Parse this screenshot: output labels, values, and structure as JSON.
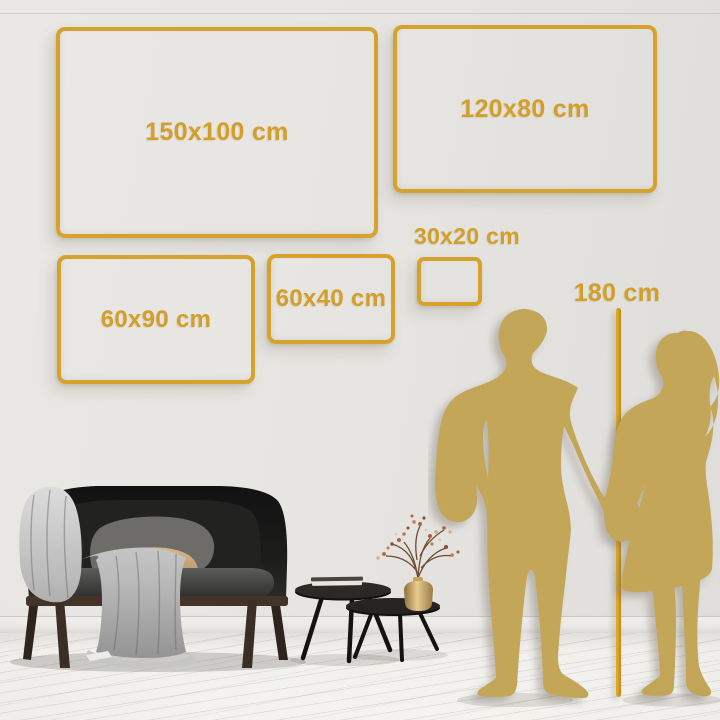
{
  "scene": {
    "title": "Canvas size comparison guide",
    "colors": {
      "accent_gold": "#D7A22C",
      "text_gold": "#D29F2A",
      "silhouette_gold": "#C3A657",
      "height_line_gold": "#D49B1F",
      "wall": "#E7E5E2",
      "floor": "#F1F0ED"
    }
  },
  "frames": [
    {
      "id": "150x100",
      "label": "150x100 cm"
    },
    {
      "id": "120x80",
      "label": "120x80 cm"
    },
    {
      "id": "60x90",
      "label": "60x90 cm"
    },
    {
      "id": "60x40",
      "label": "60x40 cm"
    },
    {
      "id": "30x20",
      "label": "30x20 cm"
    }
  ],
  "height_reference": {
    "label": "180 cm"
  }
}
